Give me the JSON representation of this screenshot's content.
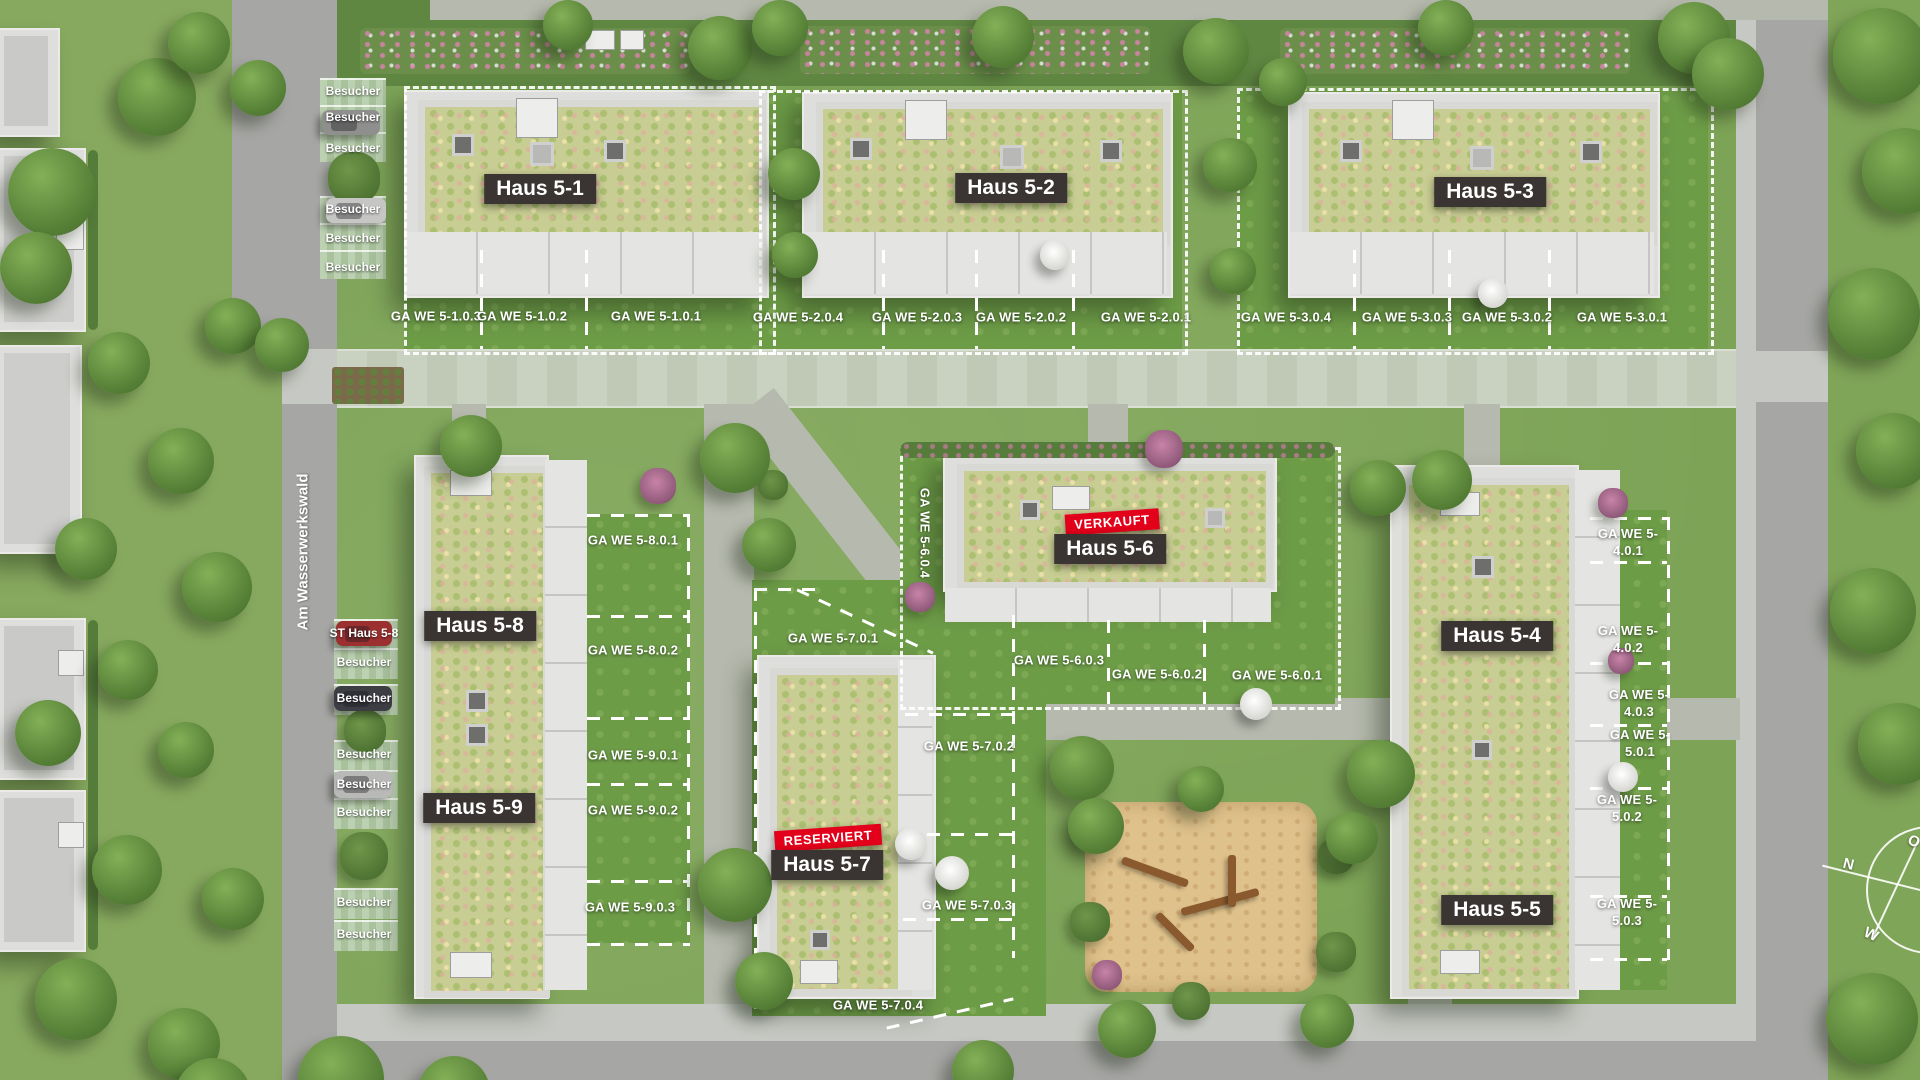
{
  "street": {
    "name": "Am Wasserwerkswald"
  },
  "houses": [
    {
      "label": "Haus 5-1"
    },
    {
      "label": "Haus 5-2"
    },
    {
      "label": "Haus 5-3"
    },
    {
      "label": "Haus 5-4"
    },
    {
      "label": "Haus 5-5"
    },
    {
      "label": "Haus 5-6"
    },
    {
      "label": "Haus 5-7"
    },
    {
      "label": "Haus 5-8"
    },
    {
      "label": "Haus 5-9"
    }
  ],
  "status": {
    "sold": "VERKAUFT",
    "reserved": "RESERVIERT"
  },
  "parking": {
    "visitor": "Besucher",
    "st_haus": "ST Haus 5-8"
  },
  "ga": {
    "h1": [
      "GA WE 5-1.0.3",
      "GA WE 5-1.0.2",
      "GA WE 5-1.0.1"
    ],
    "h2": [
      "GA WE 5-2.0.4",
      "GA WE 5-2.0.3",
      "GA WE 5-2.0.2",
      "GA WE 5-2.0.1"
    ],
    "h3": [
      "GA WE 5-3.0.4",
      "GA WE 5-3.0.3",
      "GA WE 5-3.0.2",
      "GA WE 5-3.0.1"
    ],
    "h89": [
      "GA WE 5-8.0.1",
      "GA WE 5-8.0.2",
      "GA WE 5-9.0.1",
      "GA WE 5-9.0.2",
      "GA WE 5-9.0.3"
    ],
    "h6": [
      "GA WE 5-6.0.4",
      "GA WE 5-6.0.3",
      "GA WE 5-6.0.2",
      "GA WE 5-6.0.1"
    ],
    "h7": [
      "GA WE 5-7.0.1",
      "GA WE 5-7.0.2",
      "GA WE 5-7.0.3",
      "GA WE 5-7.0.4"
    ],
    "h45": [
      "GA WE 5-4.0.1",
      "GA WE 5-4.0.2",
      "GA WE 5-4.0.3",
      "GA WE 5-5.0.1",
      "GA WE 5-5.0.2",
      "GA WE 5-5.0.3"
    ]
  },
  "compass": {
    "n": "N",
    "e": "O",
    "s": "S",
    "w": "W"
  },
  "colors": {
    "badge_dark": "#3a3432",
    "status_red": "#e2001a",
    "dash_white": "#ffffff"
  }
}
